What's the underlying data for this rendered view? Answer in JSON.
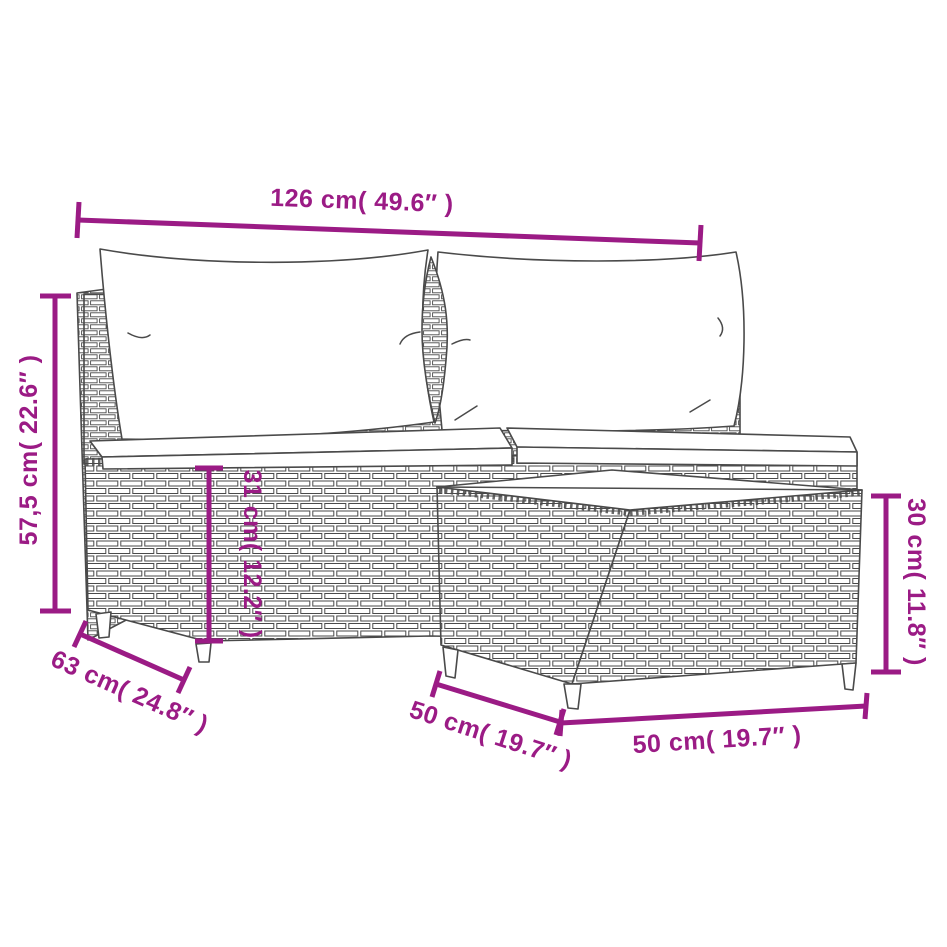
{
  "diagram": {
    "background_color": "#ffffff",
    "accent_color": "#9B1B85",
    "outline_color": "#4A4A4A",
    "cushion_color": "#FFFFFF",
    "dimensions": {
      "total_width": "126 cm( 49.6″ )",
      "total_height": "57,5 cm( 22.6″ )",
      "seat_height": "31 cm( 12.2″ )",
      "sofa_depth": "63 cm( 24.8″ )",
      "table_depth": "50 cm( 19.7″ )",
      "table_width": "50 cm( 19.7″ )",
      "table_height": "30 cm( 11.8″ )"
    }
  }
}
